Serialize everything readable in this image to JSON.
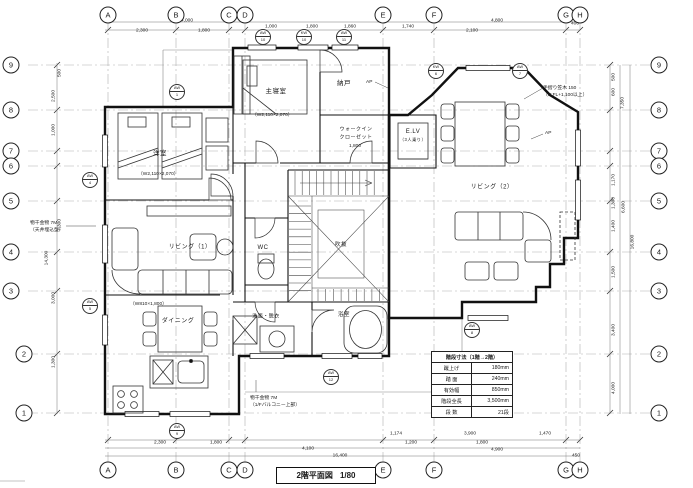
{
  "sheet": {
    "width": 693,
    "height": 488
  },
  "colors": {
    "paper": "#ffffff",
    "ink": "#1a1a1a"
  },
  "title_block": {
    "title": "2階平面図",
    "scale": "1/80"
  },
  "grid": {
    "letters": [
      {
        "id": "A",
        "x": 108
      },
      {
        "id": "B",
        "x": 176
      },
      {
        "id": "C",
        "x": 229
      },
      {
        "id": "D",
        "x": 245
      },
      {
        "id": "E",
        "x": 383
      },
      {
        "id": "F",
        "x": 434
      },
      {
        "id": "G",
        "x": 566
      },
      {
        "id": "H",
        "x": 580
      }
    ],
    "numbers": [
      {
        "id": "9",
        "y": 65,
        "lx": 11
      },
      {
        "id": "8",
        "y": 110,
        "lx": 11
      },
      {
        "id": "7",
        "y": 151,
        "lx": 11
      },
      {
        "id": "6",
        "y": 166,
        "lx": 11
      },
      {
        "id": "5",
        "y": 201,
        "lx": 11
      },
      {
        "id": "4",
        "y": 252,
        "lx": 11
      },
      {
        "id": "3",
        "y": 291,
        "lx": 11
      },
      {
        "id": "2",
        "y": 354,
        "lx": 24
      },
      {
        "id": "1",
        "y": 413,
        "lx": 24
      }
    ]
  },
  "rooms": [
    {
      "id": "western-room",
      "label": "洋室",
      "x": 160,
      "y": 152,
      "fs": 6.5
    },
    {
      "id": "master-bedroom",
      "label": "主寝室",
      "x": 276,
      "y": 90,
      "fs": 6.5
    },
    {
      "id": "storage",
      "label": "納戸",
      "x": 344,
      "y": 82,
      "fs": 6.5
    },
    {
      "id": "wic-line1",
      "label": "ウォークイン",
      "x": 356,
      "y": 129,
      "fs": 5
    },
    {
      "id": "wic-line2",
      "label": "クローゼット",
      "x": 356,
      "y": 137,
      "fs": 5
    },
    {
      "id": "elevator",
      "label": "E.LV",
      "x": 413,
      "y": 132,
      "fs": 6
    },
    {
      "id": "elevator-sub",
      "label": "（3人乗り）",
      "x": 413,
      "y": 140,
      "fs": 4.2
    },
    {
      "id": "living-1",
      "label": "リビング（1）",
      "x": 190,
      "y": 246,
      "fs": 6
    },
    {
      "id": "living-2",
      "label": "リビング（2）",
      "x": 492,
      "y": 186,
      "fs": 6
    },
    {
      "id": "dining",
      "label": "ダイニング",
      "x": 178,
      "y": 320,
      "fs": 6
    },
    {
      "id": "wc",
      "label": "WC",
      "x": 263,
      "y": 248,
      "fs": 6
    },
    {
      "id": "washroom",
      "label": "洗面・脱衣",
      "x": 266,
      "y": 316,
      "fs": 5
    },
    {
      "id": "bathroom",
      "label": "浴室",
      "x": 344,
      "y": 314,
      "fs": 5.5
    },
    {
      "id": "void",
      "label": "吹抜",
      "x": 341,
      "y": 244,
      "fs": 5.5
    }
  ],
  "notes": [
    {
      "t": "手摺り笠木 150",
      "x": 543,
      "y": 84
    },
    {
      "t": "（H:FL+1,100以上）",
      "x": 543,
      "y": 91
    },
    {
      "t": "AP",
      "x": 366,
      "y": 80
    },
    {
      "t": "AP",
      "x": 545,
      "y": 131
    },
    {
      "t": "物干金物 7M",
      "x": 30,
      "y": 219
    },
    {
      "t": "（天井埋込型）",
      "x": 30,
      "y": 226
    },
    {
      "t": "物干金物 7M",
      "x": 250,
      "y": 394
    },
    {
      "t": "（1/Fバルコニー上部）",
      "x": 250,
      "y": 401
    },
    {
      "t": "（W2,110×2,070）",
      "x": 138,
      "y": 170
    },
    {
      "t": "（W2,110×2,070）",
      "x": 252,
      "y": 111
    },
    {
      "t": "（W810×1,800）",
      "x": 130,
      "y": 300
    },
    {
      "t": "1,800",
      "x": 349,
      "y": 144
    }
  ],
  "window_markers": [
    {
      "c": "AW",
      "n": "1",
      "x": 177,
      "y": 92
    },
    {
      "c": "AW",
      "n": "10",
      "x": 263,
      "y": 37
    },
    {
      "c": "KW",
      "n": "10",
      "x": 304,
      "y": 37
    },
    {
      "c": "AW",
      "n": "11",
      "x": 344,
      "y": 37
    },
    {
      "c": "KW",
      "n": "6",
      "x": 436,
      "y": 71
    },
    {
      "c": "AW",
      "n": "7",
      "x": 520,
      "y": 71
    },
    {
      "c": "AW",
      "n": "4",
      "x": 90,
      "y": 180
    },
    {
      "c": "AW",
      "n": "5",
      "x": 90,
      "y": 306
    },
    {
      "c": "AW",
      "n": "12",
      "x": 331,
      "y": 377
    },
    {
      "c": "AW",
      "n": "9",
      "x": 177,
      "y": 431
    },
    {
      "c": "AW",
      "n": "8",
      "x": 472,
      "y": 330
    }
  ],
  "dimensions": {
    "top": [
      {
        "x": 142,
        "y": 31,
        "t": "2,300"
      },
      {
        "x": 187,
        "y": 21,
        "t": "4,000"
      },
      {
        "x": 204,
        "y": 31,
        "t": "1,800"
      },
      {
        "x": 271,
        "y": 27,
        "t": "1,000"
      },
      {
        "x": 312,
        "y": 27,
        "t": "1,800"
      },
      {
        "x": 350,
        "y": 27,
        "t": "1,860"
      },
      {
        "x": 408,
        "y": 27,
        "t": "1,740"
      },
      {
        "x": 472,
        "y": 31,
        "t": "2,100"
      },
      {
        "x": 497,
        "y": 21,
        "t": "4,800"
      },
      {
        "x": 575,
        "y": 24,
        "t": "400"
      }
    ],
    "bottom": [
      {
        "x": 160,
        "y": 443,
        "t": "2,300"
      },
      {
        "x": 216,
        "y": 443,
        "t": "1,800"
      },
      {
        "x": 308,
        "y": 449,
        "t": "4,100"
      },
      {
        "x": 340,
        "y": 456,
        "t": "16,400"
      },
      {
        "x": 396,
        "y": 434,
        "t": "1,174"
      },
      {
        "x": 411,
        "y": 443,
        "t": "1,200"
      },
      {
        "x": 470,
        "y": 434,
        "t": "3,900"
      },
      {
        "x": 482,
        "y": 443,
        "t": "1,800"
      },
      {
        "x": 497,
        "y": 450,
        "t": "4,900"
      },
      {
        "x": 545,
        "y": 434,
        "t": "1,470"
      },
      {
        "x": 576,
        "y": 456,
        "t": "450"
      }
    ],
    "left": [
      {
        "x": 60,
        "y": 73,
        "t": "500"
      },
      {
        "x": 54,
        "y": 96,
        "t": "2,500"
      },
      {
        "x": 54,
        "y": 130,
        "t": "1,000"
      },
      {
        "x": 60,
        "y": 225,
        "t": "7,300"
      },
      {
        "x": 47,
        "y": 258,
        "t": "14,300"
      },
      {
        "x": 54,
        "y": 298,
        "t": "3,000"
      },
      {
        "x": 54,
        "y": 362,
        "t": "1,300"
      }
    ],
    "right": [
      {
        "x": 614,
        "y": 77,
        "t": "500"
      },
      {
        "x": 614,
        "y": 92,
        "t": "600"
      },
      {
        "x": 623,
        "y": 103,
        "t": "7,350"
      },
      {
        "x": 614,
        "y": 180,
        "t": "1,170"
      },
      {
        "x": 614,
        "y": 203,
        "t": "1,300"
      },
      {
        "x": 614,
        "y": 226,
        "t": "1,400"
      },
      {
        "x": 624,
        "y": 207,
        "t": "6,600"
      },
      {
        "x": 633,
        "y": 242,
        "t": "16,800"
      },
      {
        "x": 614,
        "y": 272,
        "t": "1,500"
      },
      {
        "x": 614,
        "y": 330,
        "t": "3,400"
      },
      {
        "x": 614,
        "y": 388,
        "t": "4,000"
      }
    ]
  },
  "stair_table": {
    "title": "階段寸法（1階→2階）",
    "rows": [
      [
        "蹴上げ",
        "180mm"
      ],
      [
        "踏 面",
        "240mm"
      ],
      [
        "有効幅",
        "850mm"
      ],
      [
        "階段全長",
        "3,500mm"
      ],
      [
        "段 数",
        "21段"
      ]
    ]
  }
}
